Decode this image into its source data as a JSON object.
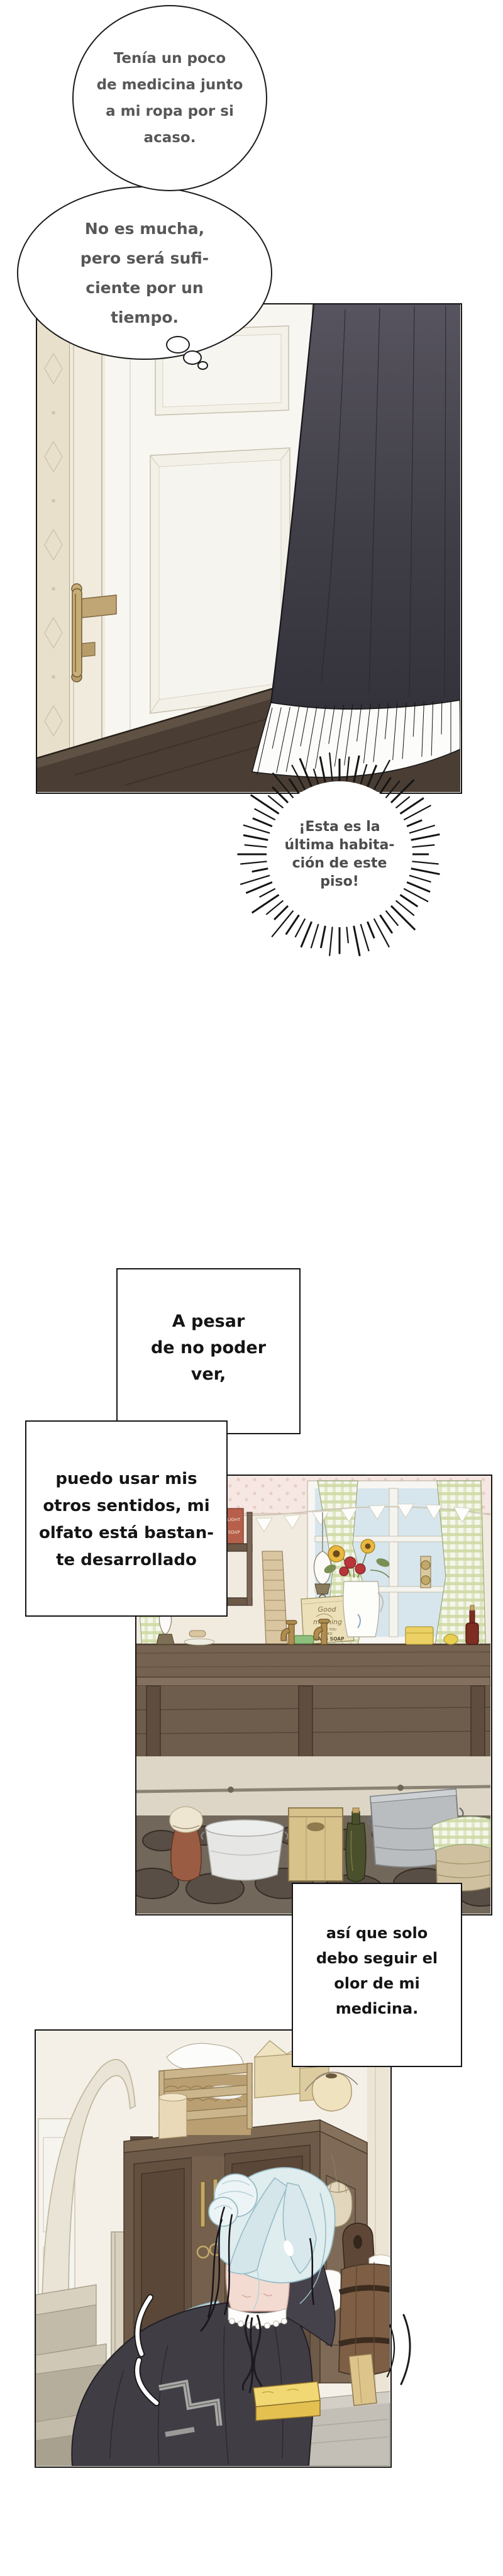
{
  "thought_bubble_1": {
    "lines": [
      "Tenía un poco",
      "de medicina junto",
      "a mi ropa por si",
      "acaso."
    ]
  },
  "thought_bubble_2": {
    "lines": [
      "No es mucha,",
      "pero será sufi-",
      "ciente por un",
      "tiempo."
    ]
  },
  "burst_bubble": {
    "lines": [
      "¡Esta es la",
      "última habita-",
      "ción de este",
      "piso!"
    ]
  },
  "caption_a": {
    "lines": [
      "A pesar",
      "de no poder",
      "ver,"
    ]
  },
  "caption_b": {
    "lines": [
      "puedo usar mis",
      "otros sentidos, mi",
      "olfato está bastan-",
      "te desarrollado"
    ]
  },
  "caption_c": {
    "lines": [
      "así que solo",
      "debo seguir el",
      "olor de mi",
      "medicina."
    ]
  },
  "kitchen": {
    "poster": {
      "line1": "Good",
      "line2": "morning",
      "line3": "HAVE YOU",
      "line4": "USED",
      "line5": "PEARS SOAP"
    },
    "soap_box": {
      "line1": "LIGHT",
      "line2": "SOAP"
    }
  },
  "colors": {
    "page_bg": "#ffffff",
    "panel_border": "#151515",
    "bubble_text": "#575757",
    "caption_text": "#141414",
    "curtain_dark": "#403e46",
    "floor_brown": "#4a3e34",
    "gingham_green": "#cdd9a4",
    "wood_dark": "#6e5c4c",
    "stone_floor": "#72675b",
    "hair_blue": "#d8e8ec",
    "dress_dark": "#413d45",
    "skin_pink": "#f4dbd2",
    "sponge_yellow": "#ecc95a",
    "brass": "#c2a869"
  }
}
